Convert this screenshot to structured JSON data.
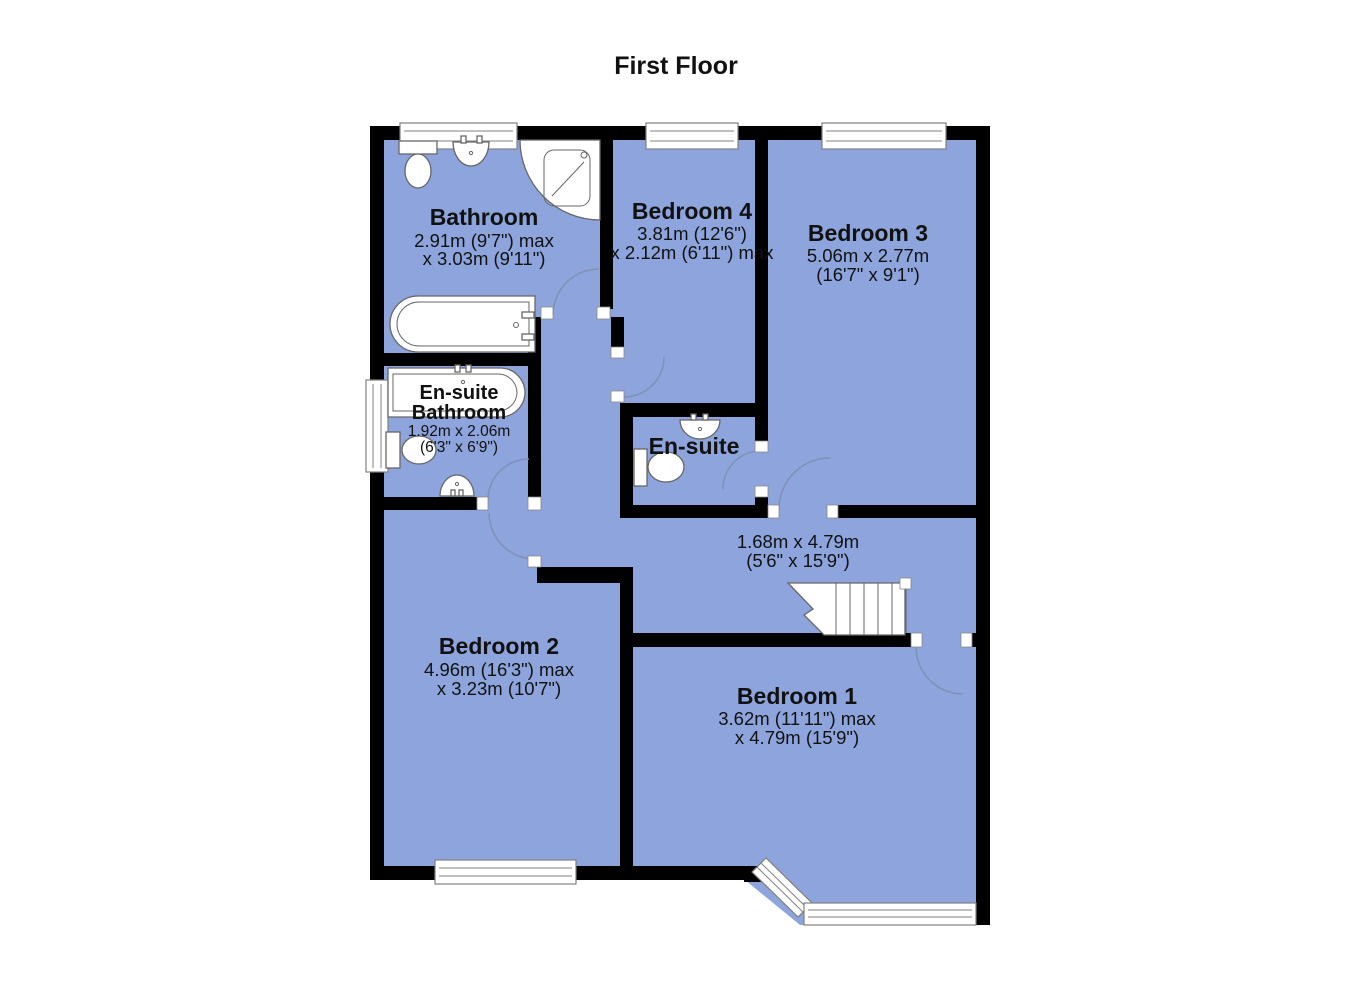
{
  "title": "First Floor",
  "rooms": {
    "bathroom": {
      "name": "Bathroom",
      "dim1": "2.91m (9'7\") max",
      "dim2": "x 3.03m (9'11\")"
    },
    "bedroom4": {
      "name": "Bedroom 4",
      "dim1": "3.81m (12'6\")",
      "dim2": "x 2.12m (6'11\") max"
    },
    "bedroom3": {
      "name": "Bedroom 3",
      "dim1": "5.06m x 2.77m",
      "dim2": "(16'7\" x 9'1\")"
    },
    "ensuite_bathroom": {
      "name_line1": "En-suite",
      "name_line2": "Bathroom",
      "dim1": "1.92m x 2.06m",
      "dim2": "(6'3\" x 6'9\")"
    },
    "ensuite": {
      "name": "En-suite"
    },
    "landing": {
      "dim1": "1.68m x 4.79m",
      "dim2": "(5'6\" x 15'9\")"
    },
    "bedroom2": {
      "name": "Bedroom 2",
      "dim1": "4.96m (16'3\") max",
      "dim2": "x 3.23m (10'7\")"
    },
    "bedroom1": {
      "name": "Bedroom 1",
      "dim1": "3.62m (11'11\") max",
      "dim2": "x 4.79m (15'9\")"
    }
  },
  "colors": {
    "room_fill": "#8da5dc",
    "wall": "#000000",
    "door_arc": "#8090b5",
    "window_frame": "#808080",
    "fixture_outline": "#666666",
    "text": "#111111"
  }
}
